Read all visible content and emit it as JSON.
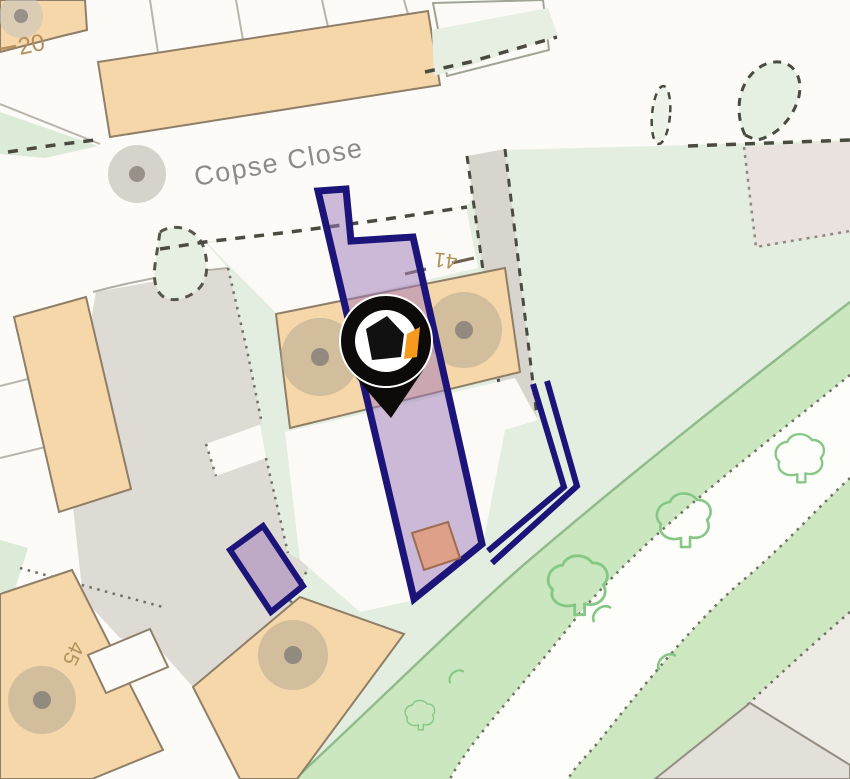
{
  "map": {
    "street_label": "Copse Close",
    "house_numbers": {
      "n20": "20",
      "n41": "41",
      "n45": "45"
    },
    "marker": {
      "name": "property-location-pin",
      "description": "black map pin with house logo"
    },
    "colors": {
      "background": "#fcfbf7",
      "building_fill": "#f6d7a9",
      "building_stroke": "#8f7e68",
      "greenery_light": "#e4eee0",
      "tree_belt": "#cbe7bf",
      "plot_outline_navy": "#1c1478",
      "plot_fill_lavender": "rgba(158,120,186,0.5)",
      "outbuilding_salmon": "#dfa089",
      "driveway_gray": "#dedad4",
      "pin_black": "#0d0b09",
      "pin_accent_orange": "#f59a1c",
      "tree_symbol_green": "#85c785",
      "label_gray": "#8b8b8b",
      "number_tan": "#b3905c"
    }
  }
}
